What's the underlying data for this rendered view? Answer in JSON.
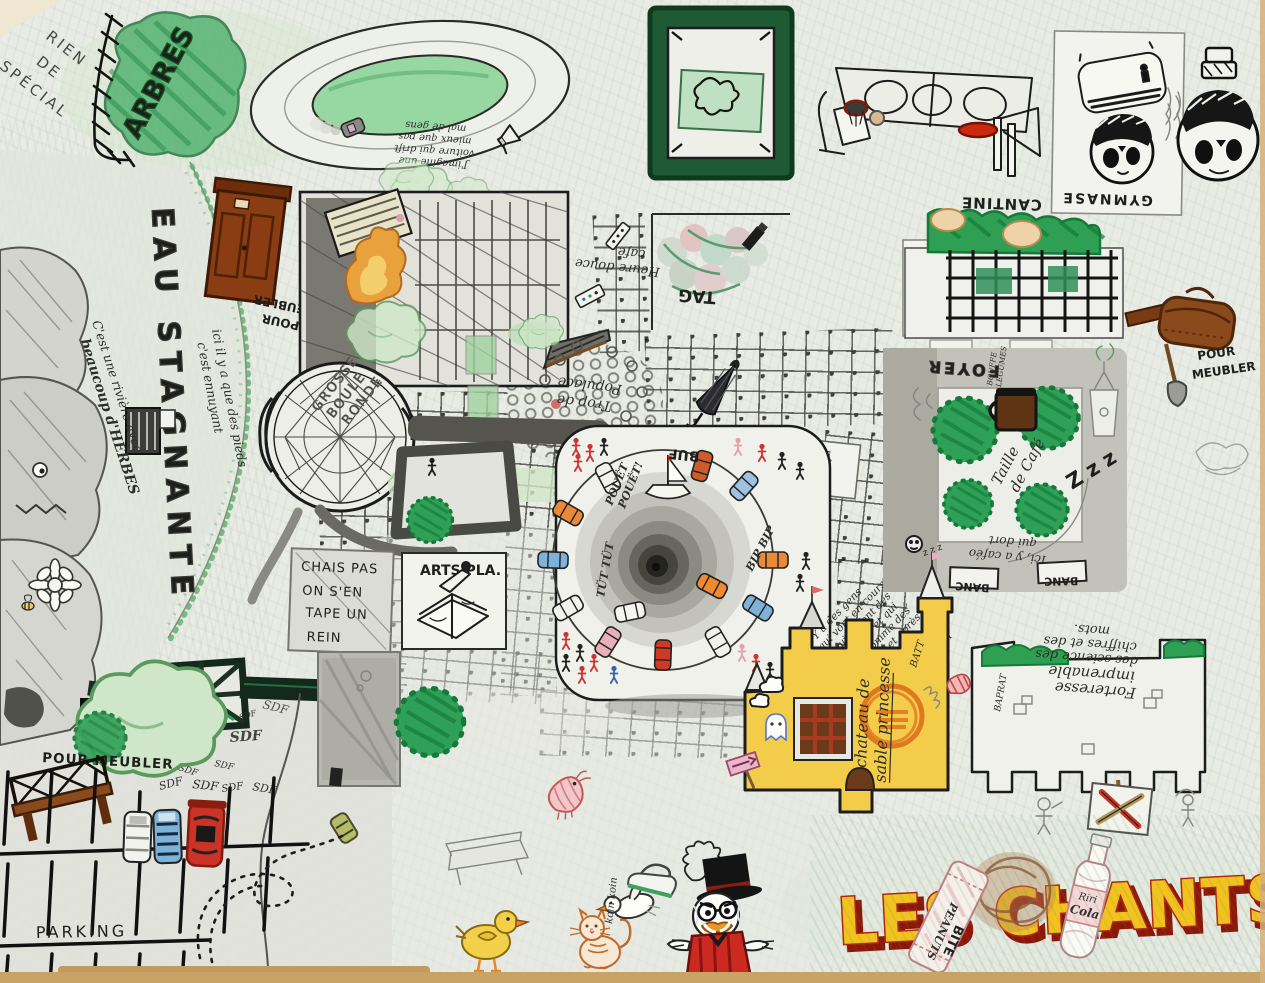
{
  "artwork": {
    "type": "hand-drawn school map (children's drawing)",
    "title": "LES CHANTS"
  },
  "colors": {
    "paper": "#e9ebe5",
    "marker_green": "#2fa057",
    "castle_yellow": "#f3cd4a",
    "banner_yellow": "#f2c31e",
    "banner_red": "#b3240f",
    "furniture_brown": "#8a3c12",
    "ink": "#1c1c1c"
  },
  "labels": {
    "rien_de_special": [
      "RIEN",
      "DE",
      "SPÉCIAL"
    ],
    "arbres": "ARBRES",
    "drift_note": [
      "J'imagine une",
      "voiture qui drift",
      "mieux que pas",
      "mal de gens"
    ],
    "gymnase": "GYMNASE",
    "cantine": "CANTINE",
    "eau_stagnante": "EAU STAGNANTE",
    "riviere_note": [
      "C'est une rivière avec",
      "beaucoup d'HERBES"
    ],
    "pieds_note": [
      "ici il y a que des pieds",
      "c'est ennuyant"
    ],
    "pour_meubler": "POUR MEUBLER",
    "pour_meubler_2": [
      "POUR",
      "MEUBLER"
    ],
    "heure_cafe": [
      "Heure douce",
      "café"
    ],
    "tag": "TAG",
    "trop_populace": [
      "Trop de",
      "Populace"
    ],
    "grosse_boule": [
      "GROSSE",
      "BOULE",
      "RONDE"
    ],
    "chais_pas": [
      "CHAIS PAS",
      "ON S'EN",
      "TAPE UN",
      "REIN"
    ],
    "arts_pla": "ARTS PLA.",
    "batiment": "BÂTIMENT",
    "pouet": [
      "POUËT",
      "POUËT!"
    ],
    "tut_tut": "TÜT TÜT",
    "bip_bip": "BIP BIP",
    "buf": "BUF",
    "bouchons_note": [
      "Y a des gens",
      "qui vont en cours",
      "et qui se font des",
      "bouchons et qui",
      "crient comme des",
      "voitures, et après",
      "qui se perdent",
      "dans les méandres",
      "des réfonds du sol"
    ],
    "foyer": "FOYER",
    "bouffe": [
      "BOUFFE",
      "LÉGUMES"
    ],
    "taille_cafe": [
      "Taille",
      "de Café"
    ],
    "zzz_big": "Z z z",
    "zzz_small": "z z z",
    "cafeo_note": [
      "Ici, y a caféo",
      "qui dort"
    ],
    "banc": "BANC",
    "chateau": [
      "chateau de",
      "sable princesse"
    ],
    "batt": "BATT",
    "forteresse": [
      "Forteresse",
      "imprenable",
      "des science des",
      "chiffres et des",
      "mots."
    ],
    "baprat": "BAPRAT",
    "sdf": "SDF",
    "parking": "PARKING",
    "koin_koin": "koin koin",
    "les_chants": "LES CHANTS",
    "peanuts": [
      "PEANUTS",
      "BITE"
    ],
    "cola": [
      "Riri",
      "Cola"
    ]
  }
}
